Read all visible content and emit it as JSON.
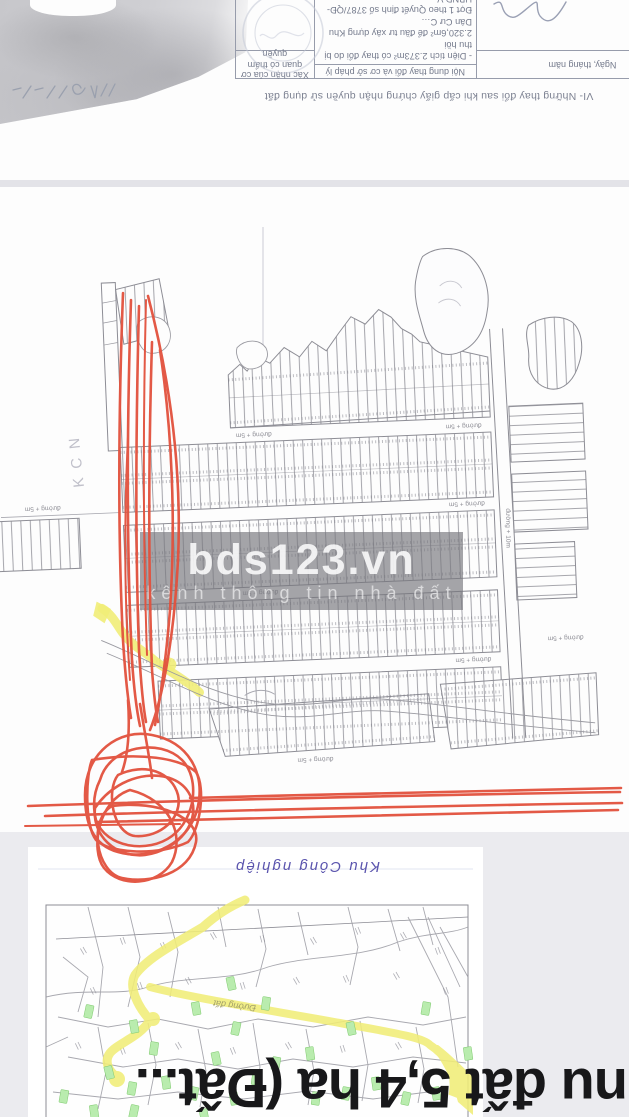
{
  "listing_title": {
    "visible_fragment": "nu đất 5,4 ha (Đất..."
  },
  "top_document": {
    "section_heading": "VI- Những thay đổi sau khi cấp giấy chứng nhận quyền sử dụng đất",
    "table_headers": {
      "col_date": "Ngày, tháng năm",
      "col_content": "Nội dung thay đổi và cơ sở pháp lý",
      "col_confirm": "Xác nhận của cơ quan có thẩm quyền"
    },
    "entry_lines": {
      "l1": "- Diện tích 2.373m² có thay đổi do bị thu hồi",
      "l2": "2.320,6m² để đầu tư xây dựng Khu Dân Cư C…",
      "l3": "Đợt 1 theo Quyết định số 3787/QĐ-UBND V…",
      "l4": "ngày 1/10/2009 của UBND huyện Đất Đỏ. Đã…"
    }
  },
  "main_map": {
    "watermark_brand": "bds123.vn",
    "watermark_tagline": "kênh thông tin nhà đất",
    "road_label_5m": "đường + 5m",
    "road_label_10m": "đường + 10m",
    "zone_label": "KCN"
  },
  "bottom_map": {
    "handwritten_label": "Khu Công nghiệp",
    "road_label": "Đường đất"
  },
  "colors": {
    "red_pen": "#e2513d",
    "yellow_road": "#f1ed78",
    "green_marker": "#b9ecae",
    "blue_ink": "#5b55ae",
    "divider": "#e3e3e8",
    "section_bg": "#ebebef",
    "title_text": "#18181a"
  }
}
